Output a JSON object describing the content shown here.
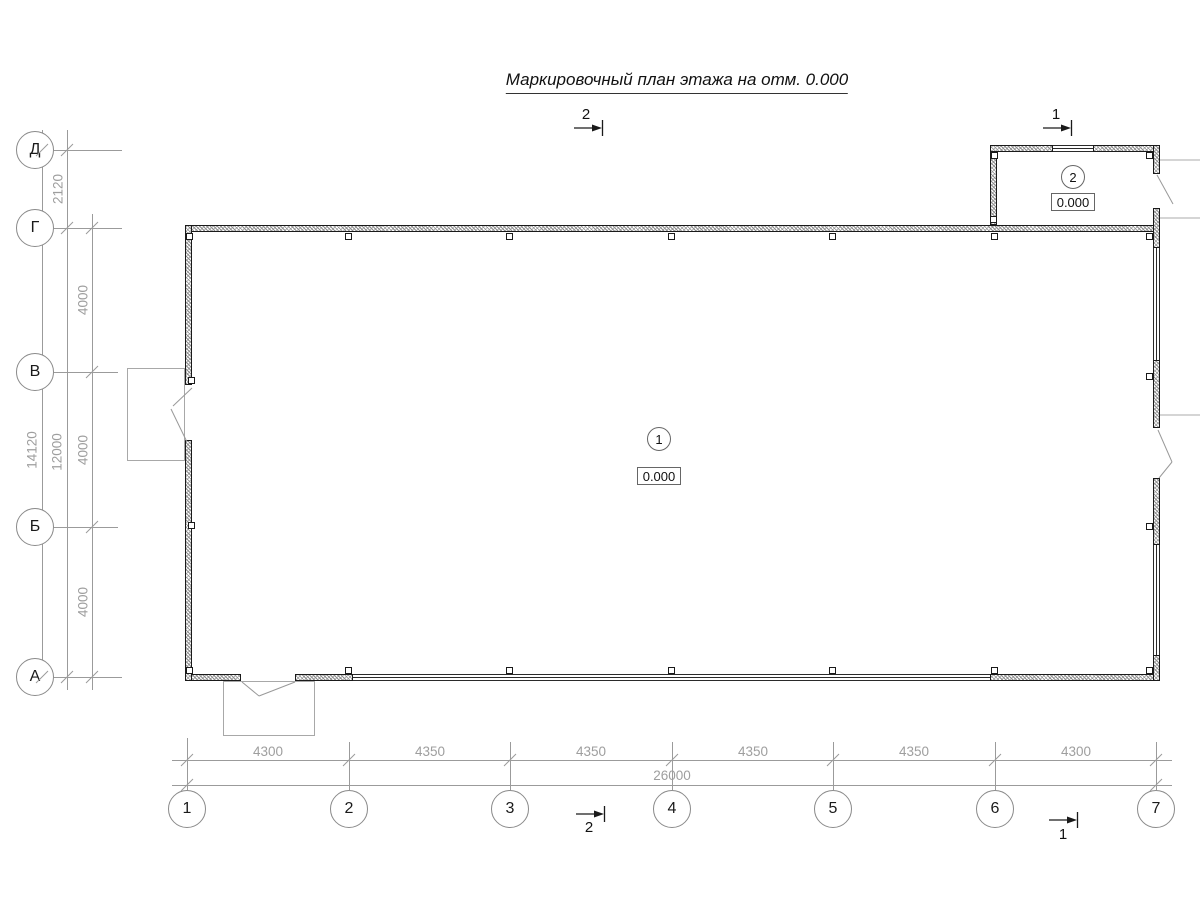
{
  "drawing": {
    "title": "Маркировочный план этажа на отм. 0.000",
    "section_marks": {
      "top_center": "2",
      "top_right": "1",
      "bottom_center": "2",
      "bottom_right": "1"
    },
    "axes": {
      "rows": [
        {
          "label": "Д"
        },
        {
          "label": "Г"
        },
        {
          "label": "В"
        },
        {
          "label": "Б"
        },
        {
          "label": "А"
        }
      ],
      "cols": [
        {
          "label": "1"
        },
        {
          "label": "2"
        },
        {
          "label": "3"
        },
        {
          "label": "4"
        },
        {
          "label": "5"
        },
        {
          "label": "6"
        },
        {
          "label": "7"
        }
      ]
    },
    "dimensions": {
      "left": {
        "segments": [
          "2120",
          "4000",
          "4000",
          "4000"
        ],
        "subtotal": "12000",
        "overall": "14120"
      },
      "bottom": {
        "segments": [
          "4300",
          "4350",
          "4350",
          "4350",
          "4350",
          "4300"
        ],
        "overall": "26000"
      }
    },
    "rooms": [
      {
        "number": "1",
        "elevation": "0.000"
      },
      {
        "number": "2",
        "elevation": "0.000"
      }
    ]
  }
}
